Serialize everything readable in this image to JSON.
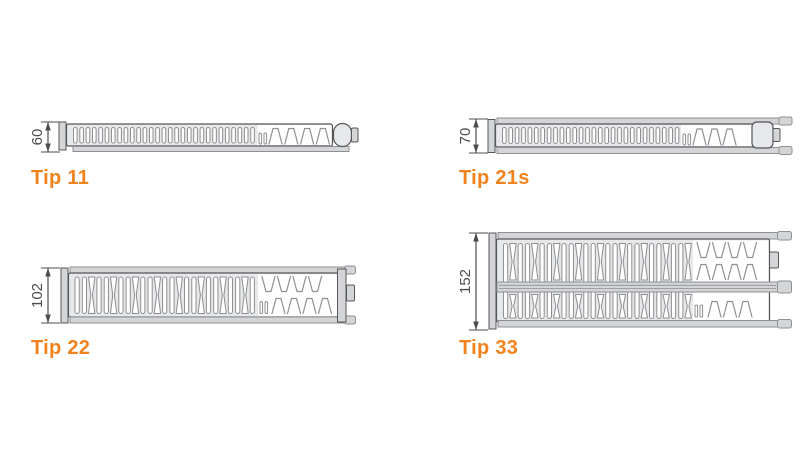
{
  "colors": {
    "accent_orange": "#f0831e",
    "line_dark": "#55565a",
    "line_mid": "#8d8f92",
    "fill_light": "#e7e8e9",
    "strip_gray": "#d4d5d7",
    "dim_gray": "#4b4c4e",
    "white": "#ffffff",
    "background": "#ffffff"
  },
  "diagrams": [
    {
      "label": "Tip 11",
      "dimension": "60"
    },
    {
      "label": "Tip 21s",
      "dimension": "70"
    },
    {
      "label": "Tip 22",
      "dimension": "102"
    },
    {
      "label": "Tip 33",
      "dimension": "152"
    }
  ]
}
